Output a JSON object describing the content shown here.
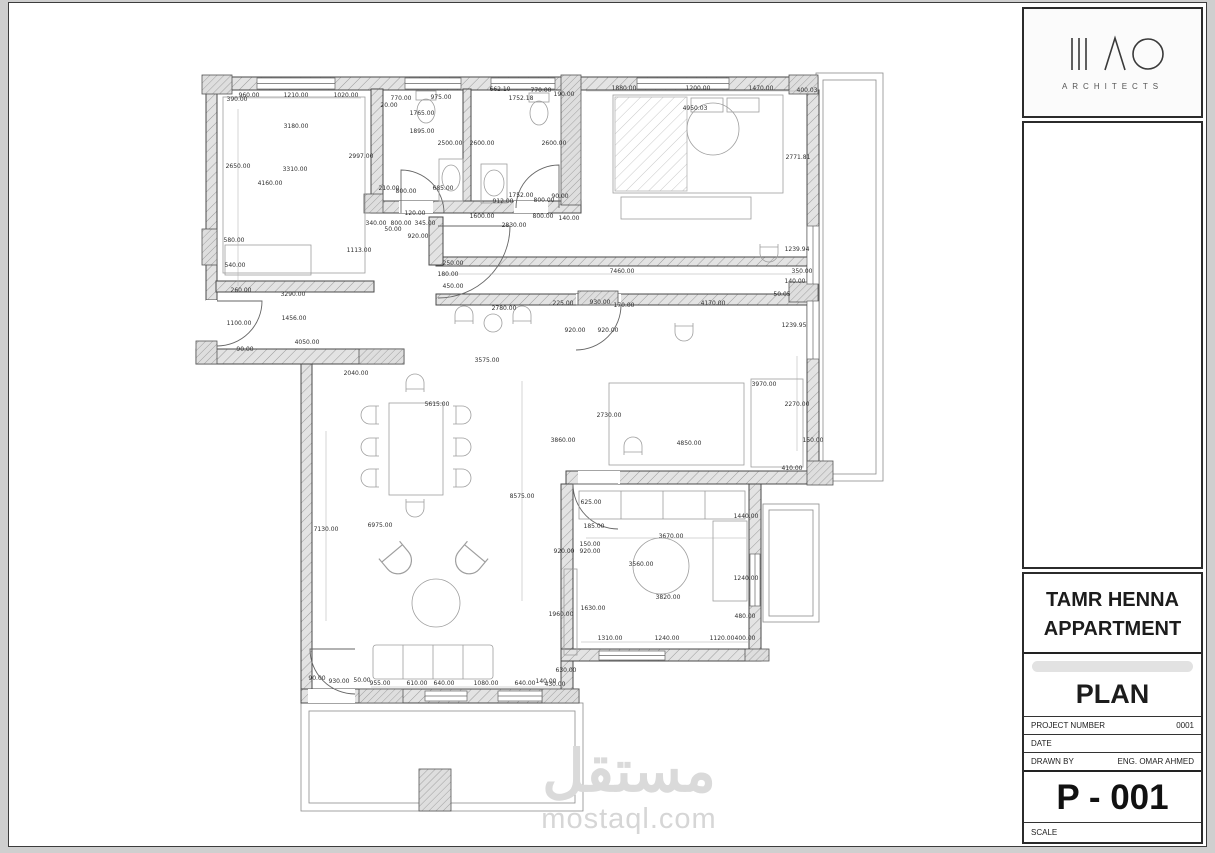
{
  "title_block": {
    "logo": {
      "subtitle": "ARCHITECTS"
    },
    "project_title_line1": "TAMR HENNA",
    "project_title_line2": "APPARTMENT",
    "drawing_title": "PLAN",
    "fields": [
      {
        "label": "PROJECT NUMBER",
        "value": "0001"
      },
      {
        "label": "DATE",
        "value": ""
      },
      {
        "label": "DRAWN BY",
        "value": "ENG. OMAR AHMED"
      }
    ],
    "sheet_number": "P - 001",
    "scale_label": "SCALE"
  },
  "watermark": {
    "arabic": "مستقل",
    "latin": "mostaql.com"
  },
  "colors": {
    "wall_hatch": "#e3e3e3",
    "wall_line": "#4a4a4a",
    "watermark": "#d9d9d9"
  },
  "plan": {
    "dimension_labels": [
      {
        "t": "960.00",
        "x": 248,
        "y": 96
      },
      {
        "t": "1210.00",
        "x": 295,
        "y": 96
      },
      {
        "t": "1020.00",
        "x": 345,
        "y": 96
      },
      {
        "t": "390.00",
        "x": 236,
        "y": 100
      },
      {
        "t": "770.00",
        "x": 400,
        "y": 99
      },
      {
        "t": "20.00",
        "x": 388,
        "y": 106
      },
      {
        "t": "975.00",
        "x": 440,
        "y": 98
      },
      {
        "t": "662.10",
        "x": 499,
        "y": 90
      },
      {
        "t": "770.00",
        "x": 540,
        "y": 91
      },
      {
        "t": "1752.18",
        "x": 520,
        "y": 99
      },
      {
        "t": "190.00",
        "x": 563,
        "y": 95
      },
      {
        "t": "1880.00",
        "x": 623,
        "y": 89
      },
      {
        "t": "1200.00",
        "x": 697,
        "y": 89
      },
      {
        "t": "1470.00",
        "x": 760,
        "y": 89
      },
      {
        "t": "400.03",
        "x": 806,
        "y": 91
      },
      {
        "t": "3180.00",
        "x": 295,
        "y": 127
      },
      {
        "t": "1765.00",
        "x": 421,
        "y": 114
      },
      {
        "t": "1895.00",
        "x": 421,
        "y": 132
      },
      {
        "t": "2997.00",
        "x": 360,
        "y": 157
      },
      {
        "t": "2500.00",
        "x": 449,
        "y": 144
      },
      {
        "t": "2600.00",
        "x": 481,
        "y": 144
      },
      {
        "t": "2600.00",
        "x": 553,
        "y": 144
      },
      {
        "t": "4950.03",
        "x": 694,
        "y": 109
      },
      {
        "t": "2771.81",
        "x": 797,
        "y": 158
      },
      {
        "t": "2650.00",
        "x": 237,
        "y": 167
      },
      {
        "t": "3310.00",
        "x": 294,
        "y": 170
      },
      {
        "t": "4160.00",
        "x": 269,
        "y": 184
      },
      {
        "t": "210.00",
        "x": 388,
        "y": 189
      },
      {
        "t": "800.00",
        "x": 405,
        "y": 192
      },
      {
        "t": "685.00",
        "x": 442,
        "y": 189
      },
      {
        "t": "1752.00",
        "x": 520,
        "y": 196
      },
      {
        "t": "912.00",
        "x": 502,
        "y": 202
      },
      {
        "t": "800.00",
        "x": 543,
        "y": 201
      },
      {
        "t": "90.00",
        "x": 559,
        "y": 197
      },
      {
        "t": "120.00",
        "x": 414,
        "y": 214
      },
      {
        "t": "1600.00",
        "x": 481,
        "y": 217
      },
      {
        "t": "800.00",
        "x": 542,
        "y": 217
      },
      {
        "t": "140.00",
        "x": 568,
        "y": 219
      },
      {
        "t": "340.00",
        "x": 375,
        "y": 224
      },
      {
        "t": "800.00",
        "x": 400,
        "y": 224
      },
      {
        "t": "345.00",
        "x": 424,
        "y": 224
      },
      {
        "t": "50.00",
        "x": 392,
        "y": 230
      },
      {
        "t": "2830.00",
        "x": 513,
        "y": 226
      },
      {
        "t": "920.00",
        "x": 417,
        "y": 237
      },
      {
        "t": "580.00",
        "x": 233,
        "y": 241
      },
      {
        "t": "1113.00",
        "x": 358,
        "y": 251
      },
      {
        "t": "540.00",
        "x": 234,
        "y": 266
      },
      {
        "t": "250.00",
        "x": 452,
        "y": 264
      },
      {
        "t": "180.00",
        "x": 447,
        "y": 275
      },
      {
        "t": "450.00",
        "x": 452,
        "y": 287
      },
      {
        "t": "260.00",
        "x": 240,
        "y": 291
      },
      {
        "t": "3290.00",
        "x": 292,
        "y": 295
      },
      {
        "t": "7460.00",
        "x": 621,
        "y": 272
      },
      {
        "t": "1239.94",
        "x": 796,
        "y": 250
      },
      {
        "t": "350.00",
        "x": 801,
        "y": 272
      },
      {
        "t": "140.00",
        "x": 794,
        "y": 282
      },
      {
        "t": "50.05",
        "x": 781,
        "y": 295
      },
      {
        "t": "1456.00",
        "x": 293,
        "y": 319
      },
      {
        "t": "1100.00",
        "x": 238,
        "y": 324
      },
      {
        "t": "2780.00",
        "x": 503,
        "y": 309
      },
      {
        "t": "225.00",
        "x": 562,
        "y": 304
      },
      {
        "t": "930.00",
        "x": 599,
        "y": 303
      },
      {
        "t": "170.00",
        "x": 623,
        "y": 306
      },
      {
        "t": "920.00",
        "x": 574,
        "y": 331
      },
      {
        "t": "920.00",
        "x": 607,
        "y": 331
      },
      {
        "t": "4170.00",
        "x": 712,
        "y": 304
      },
      {
        "t": "1239.95",
        "x": 793,
        "y": 326
      },
      {
        "t": "4050.00",
        "x": 306,
        "y": 343
      },
      {
        "t": "90.00",
        "x": 244,
        "y": 350
      },
      {
        "t": "2040.00",
        "x": 355,
        "y": 374
      },
      {
        "t": "3575.00",
        "x": 486,
        "y": 361
      },
      {
        "t": "5615.00",
        "x": 436,
        "y": 405
      },
      {
        "t": "3970.00",
        "x": 763,
        "y": 385
      },
      {
        "t": "2270.00",
        "x": 796,
        "y": 405
      },
      {
        "t": "2730.00",
        "x": 608,
        "y": 416
      },
      {
        "t": "3860.00",
        "x": 562,
        "y": 441
      },
      {
        "t": "4850.00",
        "x": 688,
        "y": 444
      },
      {
        "t": "150.00",
        "x": 812,
        "y": 441
      },
      {
        "t": "410.00",
        "x": 791,
        "y": 469
      },
      {
        "t": "625.00",
        "x": 590,
        "y": 503
      },
      {
        "t": "1440.00",
        "x": 745,
        "y": 517
      },
      {
        "t": "185.00",
        "x": 593,
        "y": 527
      },
      {
        "t": "3670.00",
        "x": 670,
        "y": 537
      },
      {
        "t": "150.00",
        "x": 589,
        "y": 545
      },
      {
        "t": "920.00",
        "x": 589,
        "y": 552
      },
      {
        "t": "920.00",
        "x": 563,
        "y": 552
      },
      {
        "t": "3560.00",
        "x": 640,
        "y": 565
      },
      {
        "t": "1240.00",
        "x": 745,
        "y": 579
      },
      {
        "t": "3820.00",
        "x": 667,
        "y": 598
      },
      {
        "t": "1630.00",
        "x": 592,
        "y": 609
      },
      {
        "t": "480.00",
        "x": 744,
        "y": 617
      },
      {
        "t": "8575.00",
        "x": 521,
        "y": 497
      },
      {
        "t": "6975.00",
        "x": 379,
        "y": 526
      },
      {
        "t": "7130.00",
        "x": 325,
        "y": 530
      },
      {
        "t": "1960.00",
        "x": 560,
        "y": 615
      },
      {
        "t": "630.00",
        "x": 565,
        "y": 671
      },
      {
        "t": "1310.00",
        "x": 609,
        "y": 639
      },
      {
        "t": "1240.00",
        "x": 666,
        "y": 639
      },
      {
        "t": "1120.00",
        "x": 721,
        "y": 639
      },
      {
        "t": "400.00",
        "x": 744,
        "y": 639
      },
      {
        "t": "90.00",
        "x": 316,
        "y": 679
      },
      {
        "t": "930.00",
        "x": 338,
        "y": 682
      },
      {
        "t": "50.00",
        "x": 361,
        "y": 681
      },
      {
        "t": "955.00",
        "x": 379,
        "y": 684
      },
      {
        "t": "610.00",
        "x": 416,
        "y": 684
      },
      {
        "t": "640.00",
        "x": 443,
        "y": 684
      },
      {
        "t": "1080.00",
        "x": 485,
        "y": 684
      },
      {
        "t": "640.00",
        "x": 524,
        "y": 684
      },
      {
        "t": "140.00",
        "x": 545,
        "y": 682
      },
      {
        "t": "430.00",
        "x": 554,
        "y": 685
      }
    ]
  }
}
